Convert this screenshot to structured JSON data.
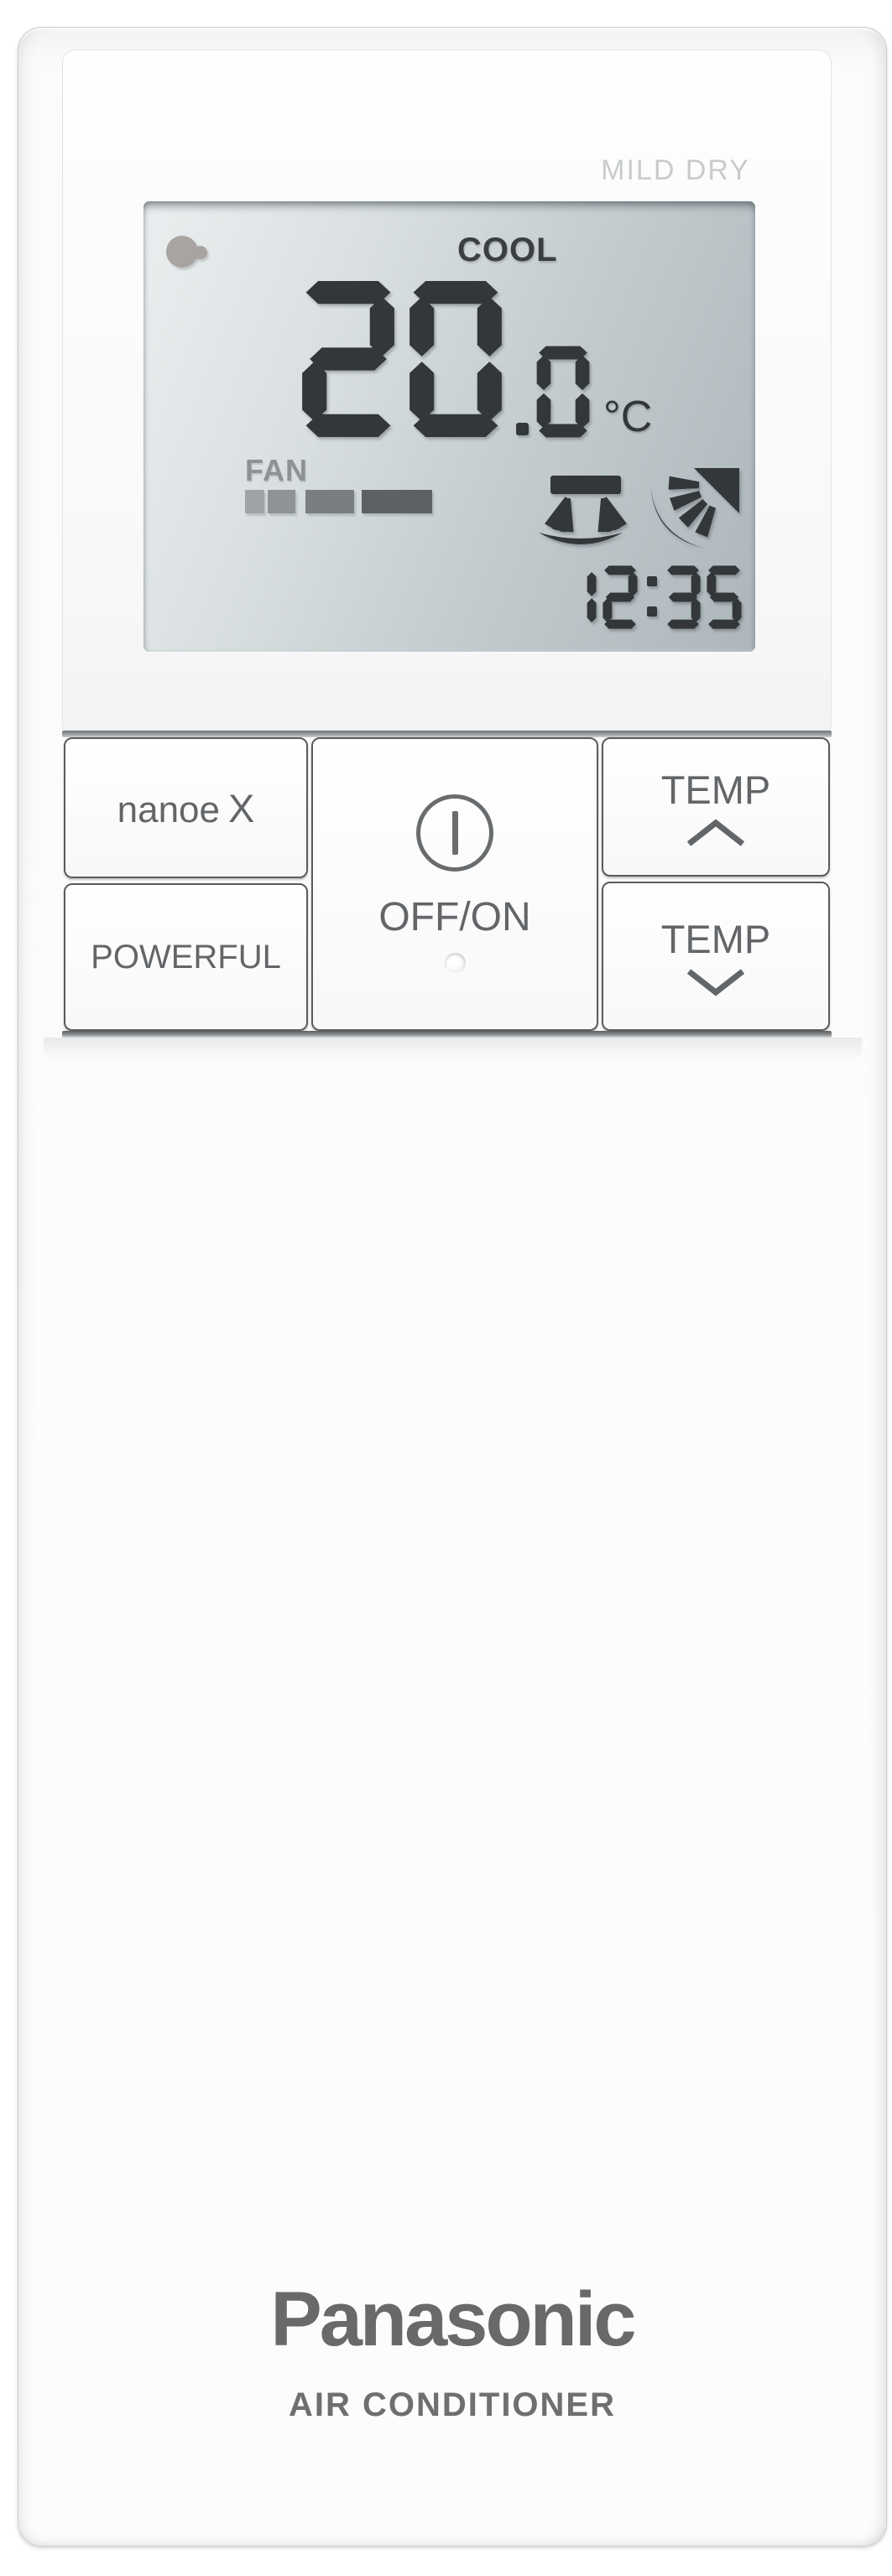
{
  "device": {
    "brand": "Panasonic",
    "product": "AIR CONDITIONER"
  },
  "top_label": "MILD DRY",
  "lcd": {
    "mode": "COOL",
    "temperature": "20.0",
    "temp_unit": "°C",
    "clock": "12:35",
    "fan": {
      "label": "FAN",
      "bars": [
        {
          "width": 23,
          "color": "#9fa3a5"
        },
        {
          "width": 33,
          "color": "#8f9395"
        },
        {
          "width": 58,
          "color": "#7a7e80"
        },
        {
          "width": 84,
          "color": "#5d6163"
        }
      ]
    },
    "icons": {
      "indicator": "nanoe-indicator-icon",
      "swing_vertical": "air-swing-vertical-icon",
      "swing_horizontal": "air-swing-horizontal-icon"
    }
  },
  "buttons": {
    "nanoe": {
      "label": "nanoe",
      "x": "X"
    },
    "powerful": {
      "label": "POWERFUL"
    },
    "power": {
      "label": "OFF/ON",
      "icon": "power-icon",
      "led": "led-indicator"
    },
    "temp_up": {
      "label": "TEMP",
      "icon": "chevron-up-icon"
    },
    "temp_down": {
      "label": "TEMP",
      "icon": "chevron-down-icon"
    }
  },
  "colors": {
    "segment": "#33373a",
    "button_text": "#636669",
    "lcd_mode_text": "#3b3f42",
    "fan_label": "#8e9295",
    "mild_dry": "#c8cbcd",
    "indicator": "#a7a4a1",
    "logo": "#69696b",
    "product": "#6d6f71"
  }
}
